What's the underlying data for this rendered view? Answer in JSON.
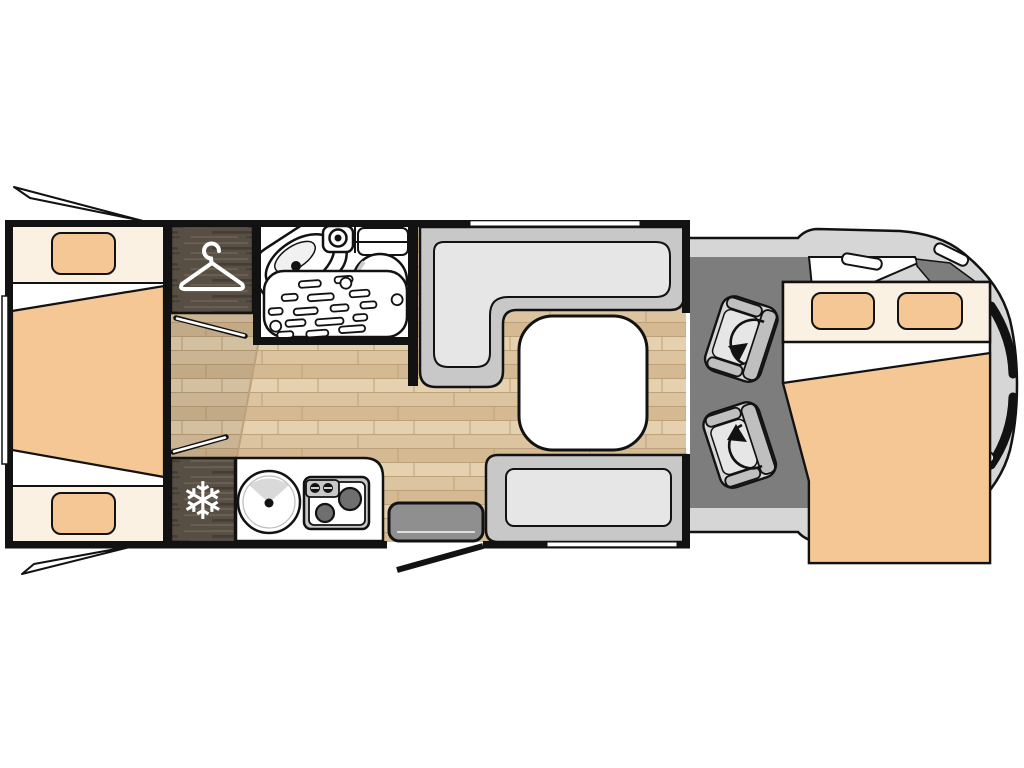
{
  "meta": {
    "type": "motorhome-floorplan-diagram",
    "view": "top-down",
    "orientation": "cab-right-rear-left"
  },
  "icons": {
    "snowflake_glyph": "❄",
    "hanger": "clothes-hanger",
    "swivel": "rotation-arrow"
  },
  "areas": {
    "rear_bedroom": {
      "name": "rear twin beds",
      "beds": 2,
      "pillows": 2,
      "duvet": "tan trapezoid"
    },
    "wardrobe": {
      "name": "wardrobe",
      "icon": "hanger-icon",
      "finish": "dark-wood"
    },
    "bathroom": {
      "name": "washroom",
      "fixtures": [
        "shower-tray",
        "vanity-sink",
        "shower-head",
        "toilet",
        "cistern"
      ]
    },
    "kitchen": {
      "name": "kitchenette",
      "fixtures": [
        "fridge",
        "round-sink",
        "two-burner-hob"
      ],
      "icon": "snowflake-icon"
    },
    "dinette": {
      "name": "lounge-dinette",
      "furniture": [
        "l-shaped-sofa",
        "bench-seat",
        "square-table"
      ]
    },
    "entry": {
      "name": "entrance",
      "features": [
        "entry-step",
        "open-door-line"
      ]
    },
    "cab": {
      "name": "driver-cab",
      "seats": [
        "driver-swivel-seat",
        "passenger-swivel-seat"
      ],
      "floor": "dark-gray"
    },
    "drop_down_bed": {
      "name": "drop-down double bed",
      "pillows": 2
    },
    "windows": [
      "rear-wall-window",
      "top-wall-window",
      "bottom-wall-window",
      "rear-awning-open-top",
      "rear-awning-open-bottom"
    ]
  },
  "colors": {
    "ink": "#121212",
    "paper": "#ffffff",
    "cream": "#faf1e2",
    "tan": "#f5c795",
    "wood": "#574e44",
    "woodL": "#685e51",
    "woodD": "#453d36",
    "floor": "#dcc4a1",
    "floorL": "#e5d1af",
    "floorD": "#d4b audio992",
    "floorDk": "#d4b992",
    "floorS": "#bda178",
    "hallShade": "#00000014",
    "seat": "#c8c8c8",
    "cushion": "#e6e6e6",
    "seatB": "#bfbfbf",
    "seatC": "#d8d8d8",
    "cabFloor": "#7d7d7d",
    "body": "#d6d6d6",
    "step": "#8f8f8f",
    "burner": "#6f6f6f",
    "fan": "#d9d9d9",
    "stepLine": "#dddddd"
  }
}
